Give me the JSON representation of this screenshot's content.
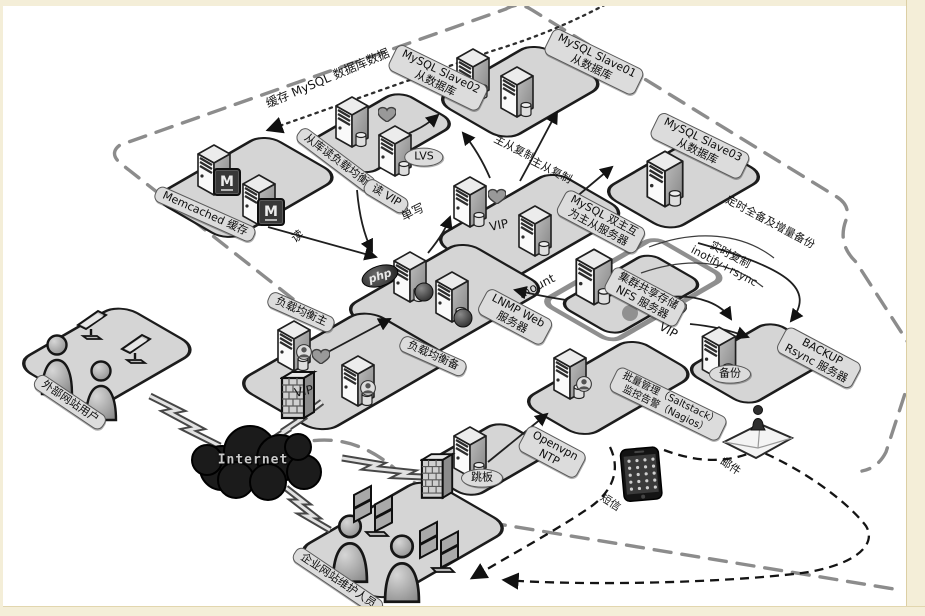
{
  "meta": {
    "description": "企业网站集群架构拓扑图 (web cluster architecture diagram)"
  },
  "colors": {
    "frame_beige": "#f4eed8",
    "platform_gray": "#d5d5d5",
    "platform_border": "#1c1c1c",
    "pill_bg": "#dcdcdc",
    "dash_gray": "#8c8c8c",
    "cloud_black": "#1b1b1b"
  },
  "labels": {
    "cache_note": "缓存 MySQL 数据库数据",
    "slave02": {
      "l1": "MySQL Slave02",
      "l2": "从数据库"
    },
    "slave01": {
      "l1": "MySQL Slave01",
      "l2": "从数据库"
    },
    "slave03": {
      "l1": "MySQL Slave03",
      "l2": "从数据库"
    },
    "read_lb": "从库读负载均衡",
    "read_vip": "读 VIP",
    "lvs": "LVS",
    "memcached": "Memcached 缓存",
    "memcached_m": "M",
    "read": "读",
    "repl_a": "主从复制",
    "repl_b": "主从复制",
    "single_write": "单写",
    "dual_master": {
      "l1": "MySQL 双主互",
      "l2": "为主从服务器"
    },
    "vip_dual": "VIP",
    "scheduled": "定时全备及增量备份",
    "realtime": {
      "l1": "实时复制",
      "l2": "inotify+rsync"
    },
    "nfs": {
      "l1": "集群共享存储",
      "l2": "NFS 服务器"
    },
    "vip_nfs": "VIP",
    "mount": "mount",
    "lnmp": {
      "l1": "LNMP Web",
      "l2": "服务器"
    },
    "php": "php",
    "lb_master": "负载均衡主",
    "lb_backup": "负载均衡备",
    "vip_lb": "VIP",
    "external_users": "外部网站用户",
    "internet": "Internet",
    "jump": "跳板",
    "openvpn": {
      "l1": "Openvpn",
      "l2": "NTP"
    },
    "mgmt": {
      "l1": "批量管理（Saltstack）",
      "l2": "监控告警（Nagios）"
    },
    "sms": "短信",
    "mail": "邮件",
    "backup_server": {
      "l1": "BACKUP",
      "l2": "Rsync 服务器"
    },
    "backup_oval": "备份",
    "maintainers": "企业网站维护人员"
  }
}
